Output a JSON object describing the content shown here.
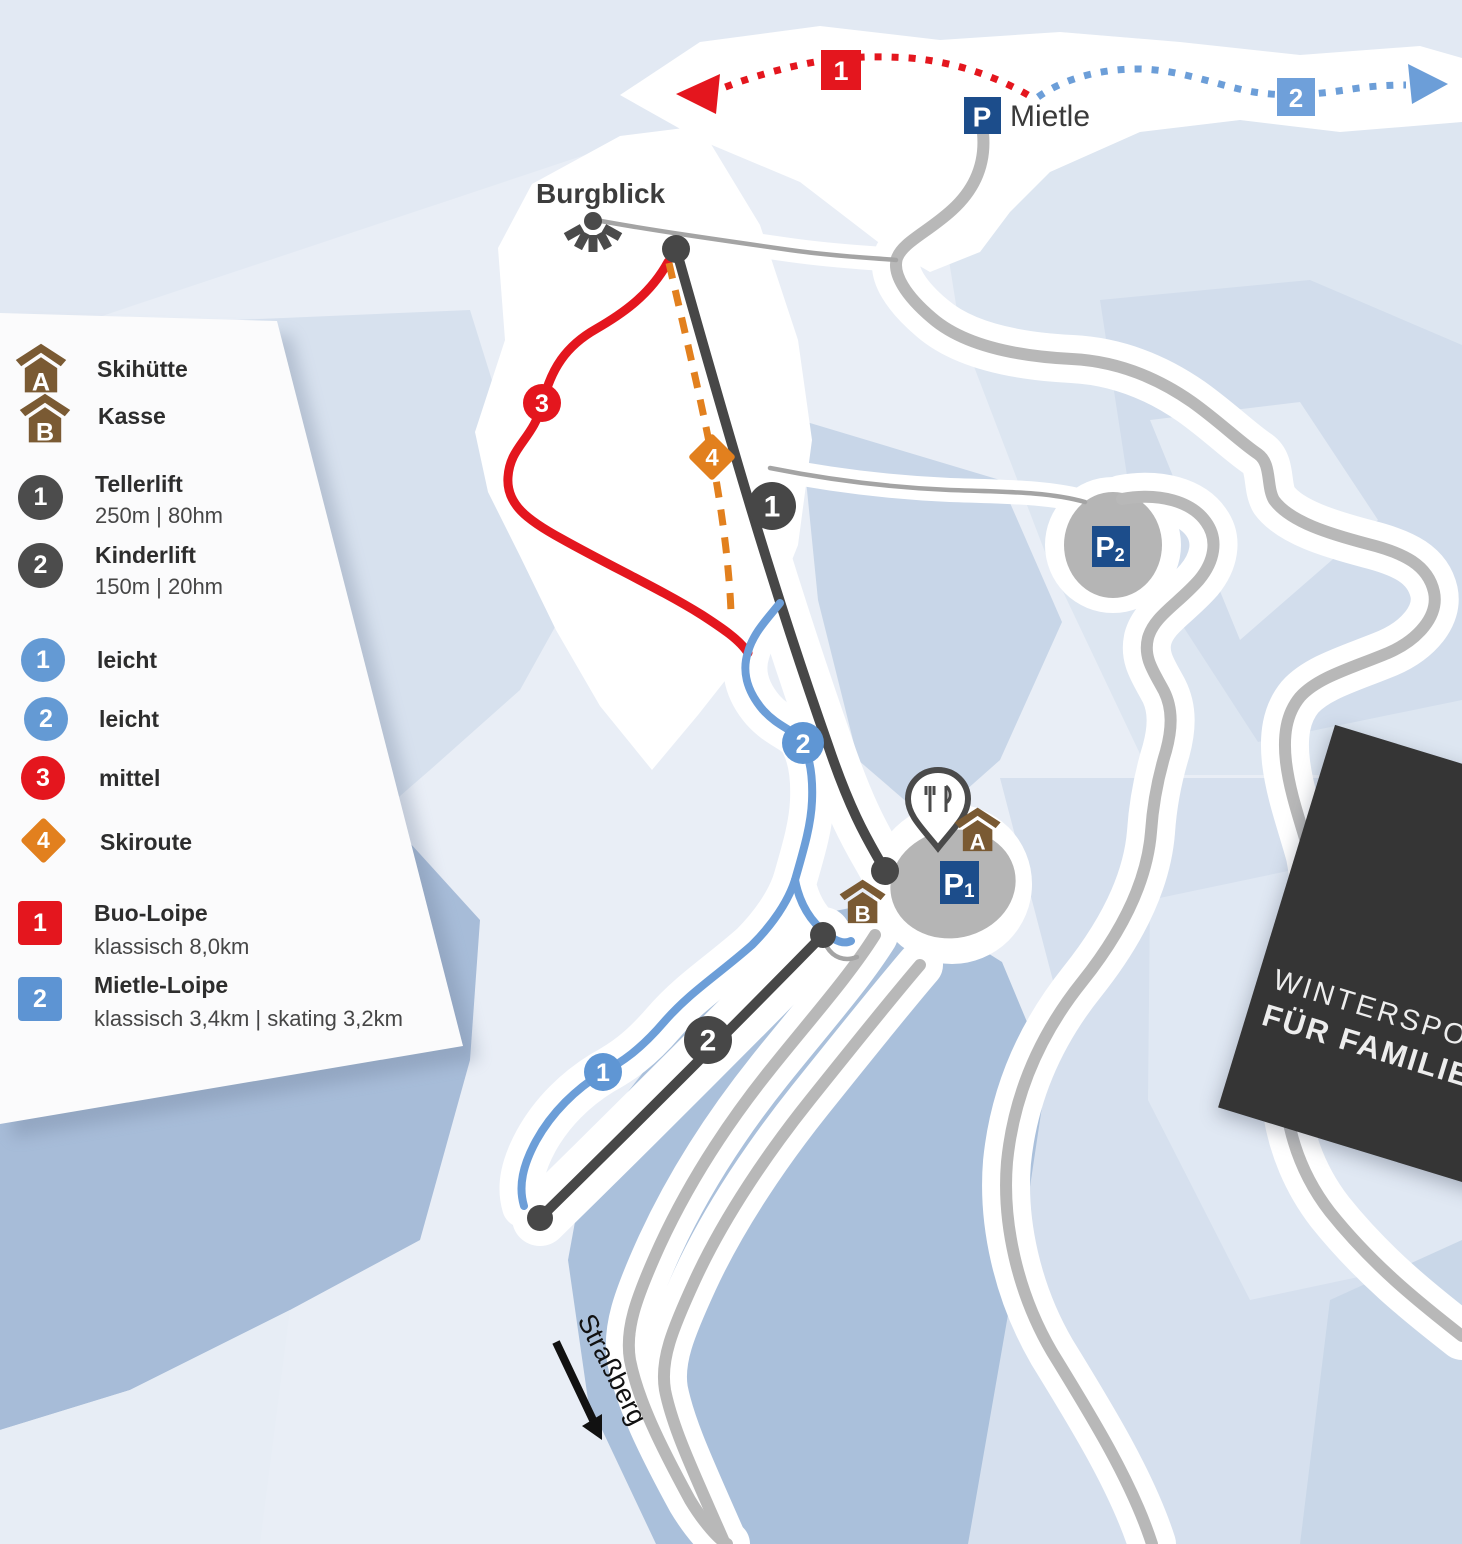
{
  "legend": {
    "items": [
      {
        "letter": "A",
        "label": "Skihütte"
      },
      {
        "letter": "B",
        "label": "Kasse"
      },
      {
        "badge": "1",
        "label": "Tellerlift",
        "detail": "250m | 80hm"
      },
      {
        "badge": "2",
        "label": "Kinderlift",
        "detail": "150m | 20hm"
      },
      {
        "badge": "1",
        "label": "leicht"
      },
      {
        "badge": "2",
        "label": "leicht"
      },
      {
        "badge": "3",
        "label": "mittel"
      },
      {
        "badge": "4",
        "label": "Skiroute"
      },
      {
        "badge": "1",
        "label": "Buo-Loipe",
        "detail": "klassisch 8,0km"
      },
      {
        "badge": "2",
        "label": "Mietle-Loipe",
        "detail": "klassisch 3,4km | skating 3,2km"
      }
    ]
  },
  "map": {
    "labels": {
      "viewpoint": "Burgblick",
      "parking_mietle_name": "Mietle",
      "road_exit": "Straßberg"
    },
    "parking": {
      "p": "P",
      "p1": "P",
      "p1_sub": "1",
      "p2": "P",
      "p2_sub": "2"
    },
    "huts": {
      "a": "A",
      "b": "B"
    },
    "markers": {
      "loipe1_route": "1",
      "loipe2_route": "2",
      "lift1": "1",
      "lift2": "2",
      "piste1": "1",
      "piste2": "2",
      "piste3": "3",
      "skiroute4": "4"
    }
  },
  "banner": {
    "line1": "WINTERSPORT",
    "line2": "FÜR FAMILIEN"
  },
  "colors": {
    "piste_easy": "#689bd5",
    "piste_medium": "#e4161e",
    "skiroute": "#e2801e",
    "lift": "#4c4c4c",
    "road": "#b8b8b8",
    "parking": "#1c4d8b",
    "hut": "#7a5a33",
    "banner_bg": "#353535"
  }
}
